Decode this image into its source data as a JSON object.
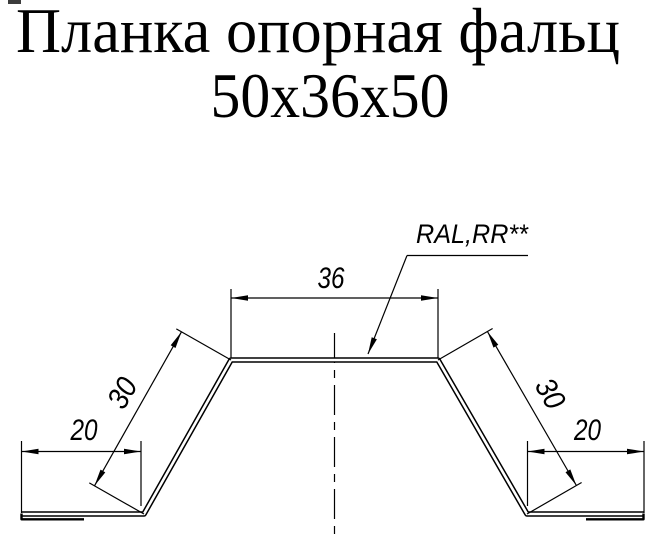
{
  "title": {
    "line1": "Планка опорная фальц",
    "line2": "50x36x50"
  },
  "dimensions": {
    "top_width": "36",
    "left_side": "30",
    "right_side": "30",
    "left_flange": "20",
    "right_flange": "20"
  },
  "labels": {
    "coating": "RAL,RR**"
  },
  "colors": {
    "ink": "#000000",
    "background": "#ffffff"
  }
}
